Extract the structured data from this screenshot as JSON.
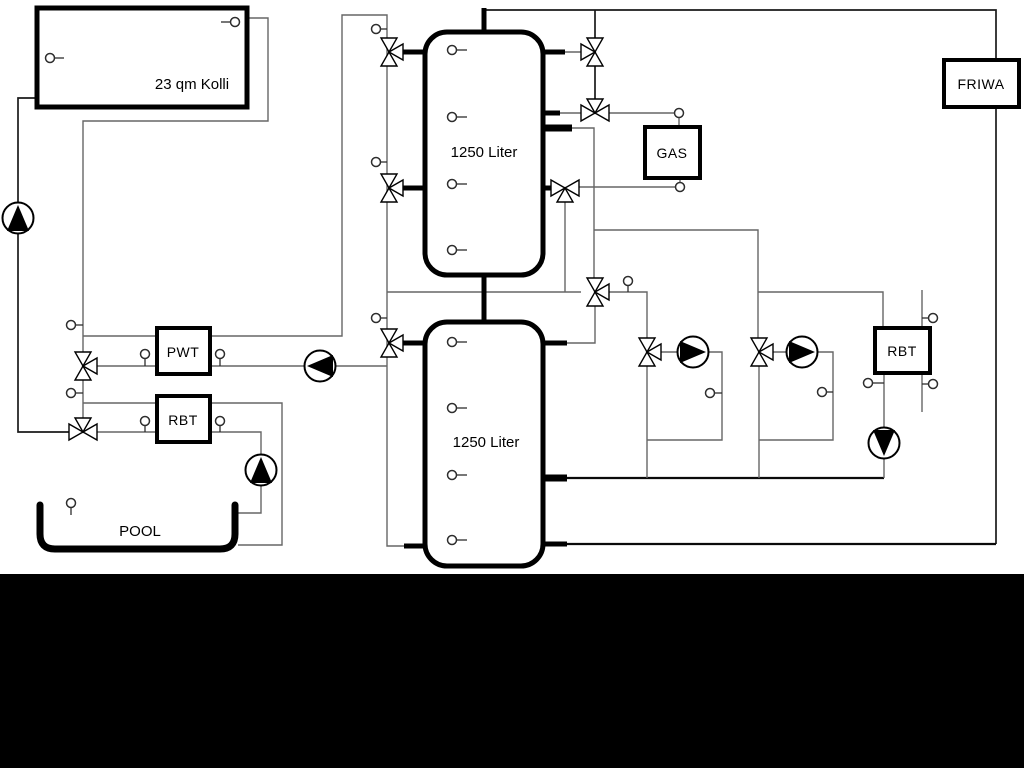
{
  "diagram": {
    "title": "heating-system-schematic",
    "labels": {
      "collector": "23 qm Kolli",
      "tank1": "1250 Liter",
      "tank2": "1250 Liter",
      "gas": "GAS",
      "friwa": "FRIWA",
      "pwt": "PWT",
      "rbt_left": "RBT",
      "rbt_right": "RBT",
      "pool": "POOL"
    },
    "colors": {
      "pipe": "#666666",
      "pipe_dark": "#1a1a1a",
      "component_border": "#000000",
      "background": "#ffffff",
      "footer_band": "#000000"
    },
    "component_counts": {
      "pumps": 6,
      "three_way_valves": 11,
      "temperature_sensors": 25
    }
  }
}
